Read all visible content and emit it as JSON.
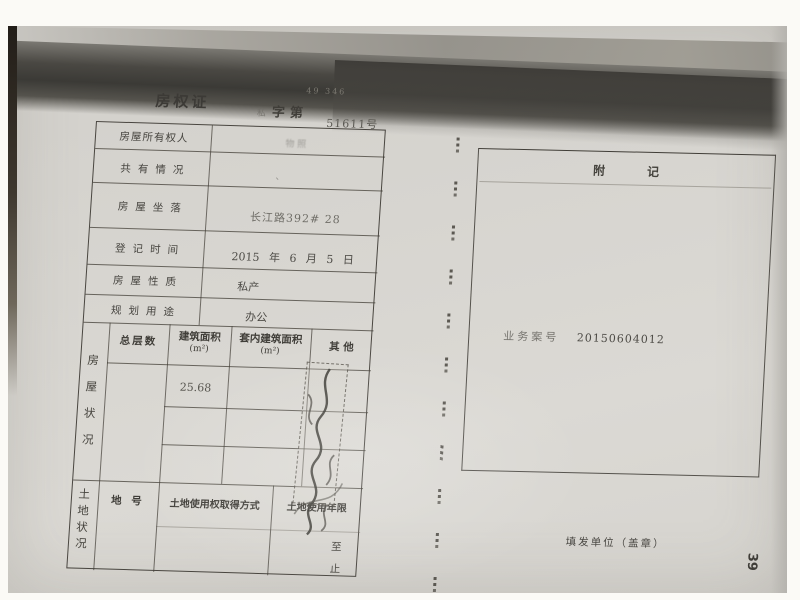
{
  "colors": {
    "paper": "#d6d4cf",
    "ink": "#45433d",
    "shadow": "#3b3a36"
  },
  "page": {
    "title_row": {
      "title": "房权证",
      "prefix": "私",
      "zi_di": "字第",
      "number": "51611号",
      "faint_serial": "49 346"
    },
    "fields": [
      {
        "label": "房屋所有权人",
        "value": "物 照"
      },
      {
        "label": "共有情况",
        "value": "、"
      },
      {
        "label": "房屋坐落",
        "value": "长江路392# 28"
      },
      {
        "label": "登记时间",
        "value": "2015 年 6 月 5 日"
      },
      {
        "label": "房屋性质",
        "value": "私产"
      },
      {
        "label": "规划用途",
        "value": "办公"
      }
    ],
    "house": {
      "side_label": "房屋状况",
      "headers": [
        {
          "t": "总层数",
          "s": ""
        },
        {
          "t": "建筑面积",
          "s": "(m²)"
        },
        {
          "t": "套内建筑面积",
          "s": "(m²)"
        },
        {
          "t": "其  他",
          "s": ""
        }
      ],
      "area_value": "25.68"
    },
    "land": {
      "side_label": "土地状况",
      "plot_label": "地 号",
      "acquire_label": "土地使用权取得方式",
      "tenure_label": "土地使用年限",
      "to_label": "至",
      "end_label": "止"
    },
    "annex": {
      "header_a": "附",
      "header_b": "记",
      "case_label": "业务案号",
      "case_number": "20150604012"
    },
    "footer": {
      "issuer": "填发单位（盖章）",
      "page_number": "39"
    }
  }
}
